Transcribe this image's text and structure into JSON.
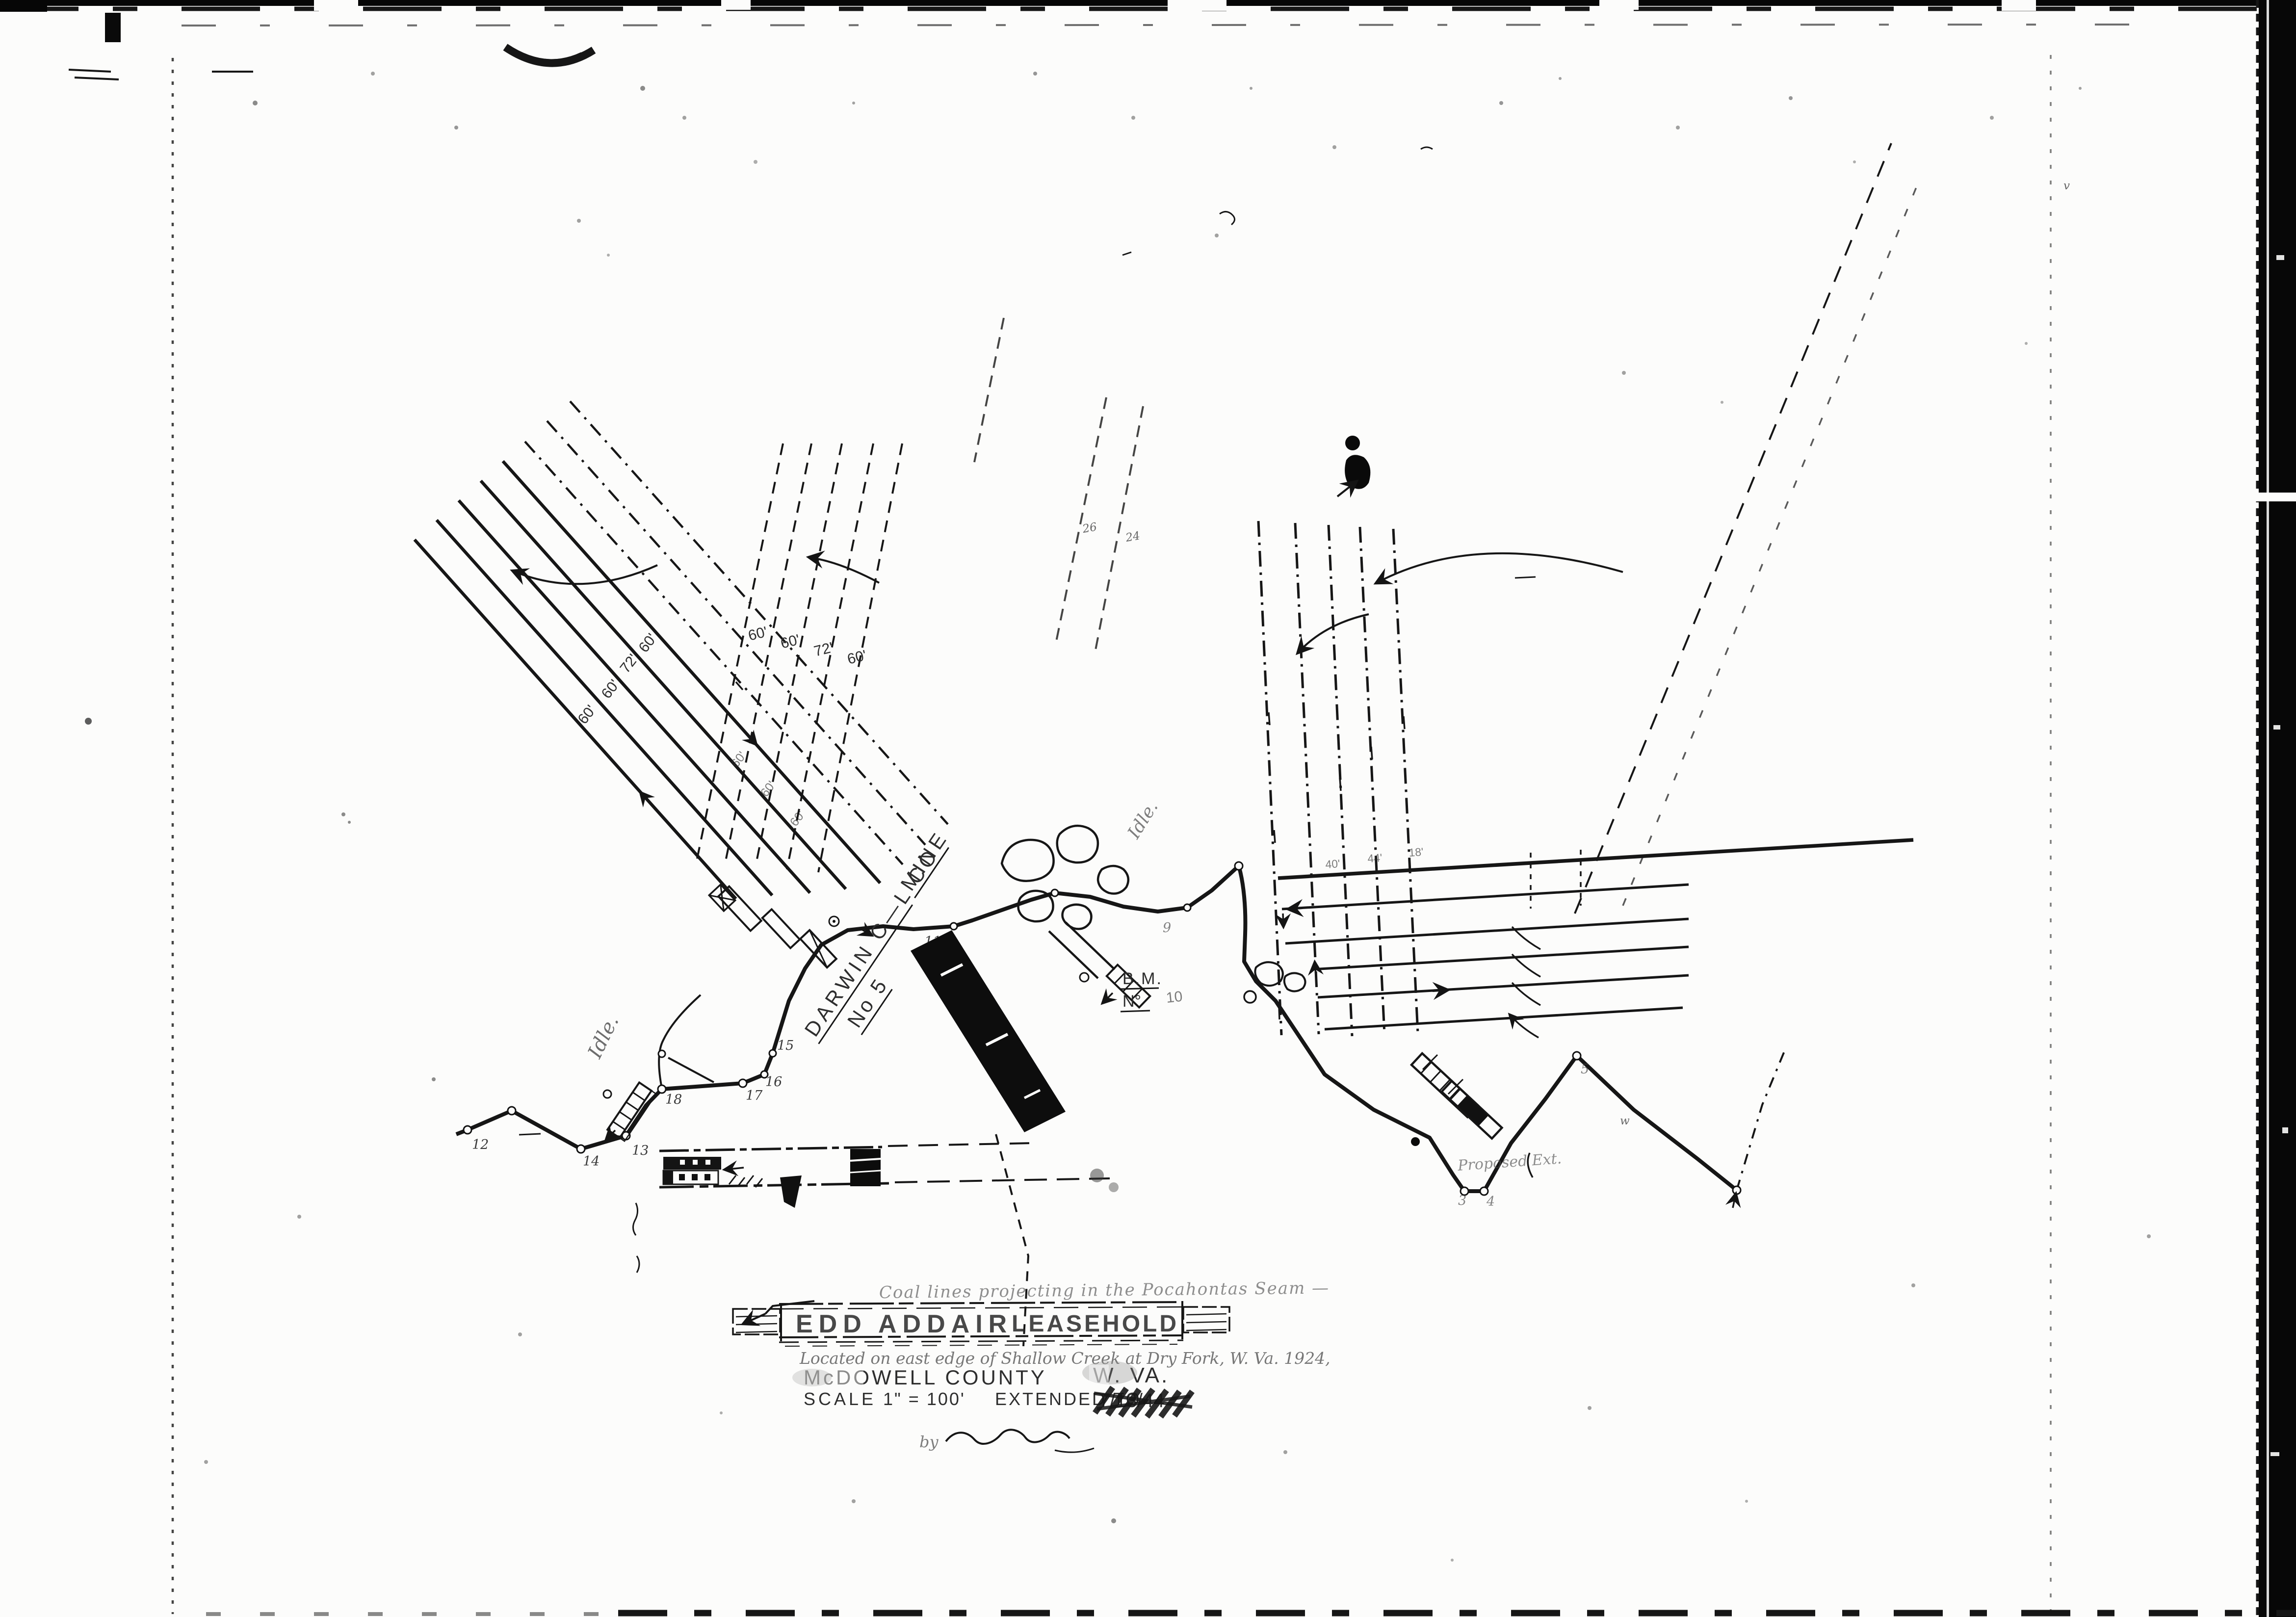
{
  "title_block": {
    "annotation": "Coal lines projecting in the Pocahontas Seam —",
    "title_word1": "EDD",
    "title_word2": "ADDAIR",
    "title_word3": "LEASEHOLD",
    "located_line": "Located on east edge of Shallow Creek at Dry Fork, W. Va. 1924,",
    "county": "McDOWELL COUNTY",
    "state": "W. VA.",
    "scale_label": "SCALE",
    "scale_value": "1\" = 100'",
    "extended_label": "EXTENDED TO",
    "extended_value": "7/13/44",
    "byline": "by"
  },
  "labels": {
    "company_line1": "DARWIN C—L CO",
    "company_line2": "MINE",
    "company_line3": "No 5",
    "idle": "Idle.",
    "benchmark": "B.M.",
    "benchmark_no": "N°",
    "benchmark_value": "10",
    "proposed": "Proposed Ext.",
    "left_spacings": [
      "60'",
      "60'",
      "72'",
      "60'"
    ],
    "cross_spacings": [
      "60'",
      "60'",
      "72'",
      "60'"
    ],
    "mid_spacings": [
      "60'",
      "60'",
      "60'"
    ],
    "entry_widths": [
      "40'",
      "44'",
      "18'"
    ],
    "stations": [
      "11",
      "12",
      "13",
      "14",
      "15",
      "16",
      "17",
      "18"
    ],
    "stations_faint": [
      "3",
      "4",
      "5",
      "9"
    ],
    "misc": [
      "26",
      "24",
      "w",
      "v"
    ]
  }
}
